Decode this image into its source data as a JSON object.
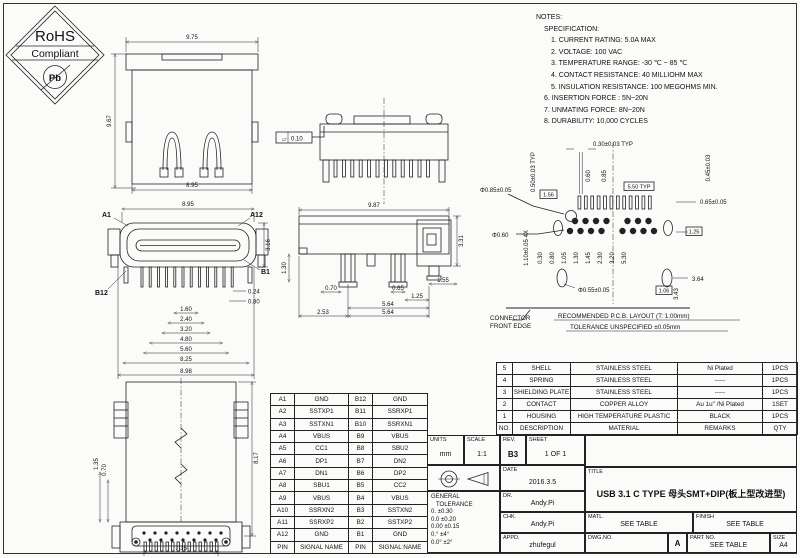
{
  "logo": {
    "line1": "RoHS",
    "line2": "Compliant",
    "pb": "Pb"
  },
  "notes": {
    "heading": "NOTES:",
    "subheading": "SPECIFICATION:",
    "items": [
      "1. CURRENT RATING: 5.0A MAX",
      "2. VOLTAGE: 100 VAC",
      "3. TEMPERATURE RANGE: -30 ℃ ~ 85 ℃",
      "4. CONTACT RESISTANCE: 40 MILLIOHM MAX",
      "5. INSULATION RESISTANCE: 100 MEGOHMS MIN.",
      "6. INSERTION FORCE : 5N~20N",
      "7. UNMATING FORCE: 8N~20N",
      "8. DURABILITY: 10,000 CYCLES"
    ]
  },
  "views": {
    "mating": {
      "top": "9.75",
      "left": "9.67",
      "bottom": "8.95"
    },
    "rear": {
      "flatness_symbol": "▱",
      "flatness": "0.10"
    },
    "front": {
      "top": "8.95",
      "right": "3.16",
      "pin_a1": "A1",
      "pin_a12": "A12",
      "pin_b1": "B1",
      "pin_b12": "B12",
      "offset_a": "0.24",
      "offset_b": "0.80",
      "stack": [
        "1.60",
        "2.40",
        "3.20",
        "4.80",
        "5.60",
        "8.25",
        "8.98"
      ]
    },
    "side": {
      "top": "9.87",
      "right": "3.31",
      "cap": "1.55",
      "left": "1.30",
      "leg_a": "0.70",
      "leg_b": "0.65",
      "pitch": "1.25",
      "span_a": "5.64",
      "span_b": "5.64",
      "offset": "2.53"
    },
    "bottom": {
      "right": "8.17",
      "left_a": "1.35",
      "left_b": "0.70",
      "bottom": "7.35"
    },
    "pcb": {
      "top_dim": "0.30±0.03 TYP",
      "pad_len_a": "0.60",
      "pad_len_b": "0.85",
      "boxed_pitch": "5.50 TYP",
      "left_box": "1.56",
      "hole_dim": "Φ0.85±0.05",
      "left_edge_dim": "0.50±0.03 TYP",
      "oval_dim": "0.65±0.05",
      "right_edge_dim": "0.45±0.03",
      "right_box": "1.25",
      "left_mid_dim": "1.10±0.05 4X",
      "left_diag_dim": "Φ0.60",
      "bottom_hole_dim": "Φ0.55±0.05",
      "bottom_span": "3.64",
      "bottom_height": "3.43",
      "bottom_box": "1.06",
      "pitch_dims": [
        "0.30",
        "0.80",
        "1.05",
        "1.30",
        "1.45",
        "2.30",
        "3.20",
        "5.30"
      ],
      "edge_label_1": "CONNECTOR",
      "edge_label_2": "FRONT EDGE",
      "note_1": "RECOMMENDED  P.C.B. LAYOUT (T: 1.00mm)",
      "note_2": "TOLERANCE UNSPECIFIED ±0.05mm"
    }
  },
  "pin_table": {
    "rows": [
      [
        "A1",
        "GND",
        "B12",
        "GND"
      ],
      [
        "A2",
        "SSTXP1",
        "B11",
        "SSRXP1"
      ],
      [
        "A3",
        "SSTXN1",
        "B10",
        "SSRXN1"
      ],
      [
        "A4",
        "VBUS",
        "B9",
        "VBUS"
      ],
      [
        "A5",
        "CC1",
        "B8",
        "SBU2"
      ],
      [
        "A6",
        "DP1",
        "B7",
        "DN2"
      ],
      [
        "A7",
        "DN1",
        "B6",
        "DP2"
      ],
      [
        "A8",
        "SBU1",
        "B5",
        "CC2"
      ],
      [
        "A9",
        "VBUS",
        "B4",
        "VBUS"
      ],
      [
        "A10",
        "SSRXN2",
        "B3",
        "SSTXN2"
      ],
      [
        "A11",
        "SSRXP2",
        "B2",
        "SSTXP2"
      ],
      [
        "A12",
        "GND",
        "B1",
        "GND"
      ],
      [
        "PIN",
        "SIGNAL NAME",
        "PIN",
        "SIGNAL NAME"
      ]
    ]
  },
  "bom_table": {
    "rows": [
      [
        "5",
        "SHELL",
        "STAINLESS STEEL",
        "Ni Plated",
        "1PCS"
      ],
      [
        "4",
        "SPRING",
        "STAINLESS STEEL",
        "-----",
        "1PCS"
      ],
      [
        "3",
        "SHIELDING PLATE",
        "STAINLESS STEEL",
        "-----",
        "1PCS"
      ],
      [
        "2",
        "CONTACT",
        "COPPER ALLOY",
        "Au 1u\" /Ni Plated",
        "1SET"
      ],
      [
        "1",
        "HOUSING",
        "HIGH TEMPERATURE PLASTIC",
        "BLACK",
        "1PCS"
      ],
      [
        "NO.",
        "DESCRIPTION",
        "MATERIAL",
        "REMARKS",
        "QTY"
      ]
    ]
  },
  "title_block": {
    "units_label": "UNITS",
    "units_value": "mm",
    "scale_label": "SCALE",
    "scale_value": "1:1",
    "rev_label": "REV.",
    "rev_value": "B3",
    "sheet_label": "SHEET",
    "sheet_value": "1 OF 1",
    "date_label": "DATE",
    "date_value": "2016.3.5",
    "dr_label": "DR.",
    "dr_value": "Andy.Pi",
    "chk_label": "CHK.",
    "chk_value": "Andy.Pi",
    "appd_label": "APPD.",
    "appd_value": "zhufegul",
    "tol_title_1": "GENERAL",
    "tol_title_2": "TOLERANCE",
    "tol_lines": [
      "0.   ±0.30",
      "0.0  ±0.20",
      "0.00 ±0.15",
      "0.°   ±4°",
      "0.0°  ±2°"
    ],
    "title_label": "TITLE",
    "title_value": "USB 3.1 C TYPE 母头SMT+DIP(板上型改进型)",
    "matl_label": "MATL.",
    "matl_value": "SEE TABLE",
    "finish_label": "FINISH",
    "finish_value": "SEE TABLE",
    "dwgno_label": "DWG.NO.",
    "dwg_rev": "A",
    "partno_label": "PART NO.",
    "partno_value": "SEE TABLE",
    "size_label": "SIZE",
    "size_value": "A4"
  }
}
